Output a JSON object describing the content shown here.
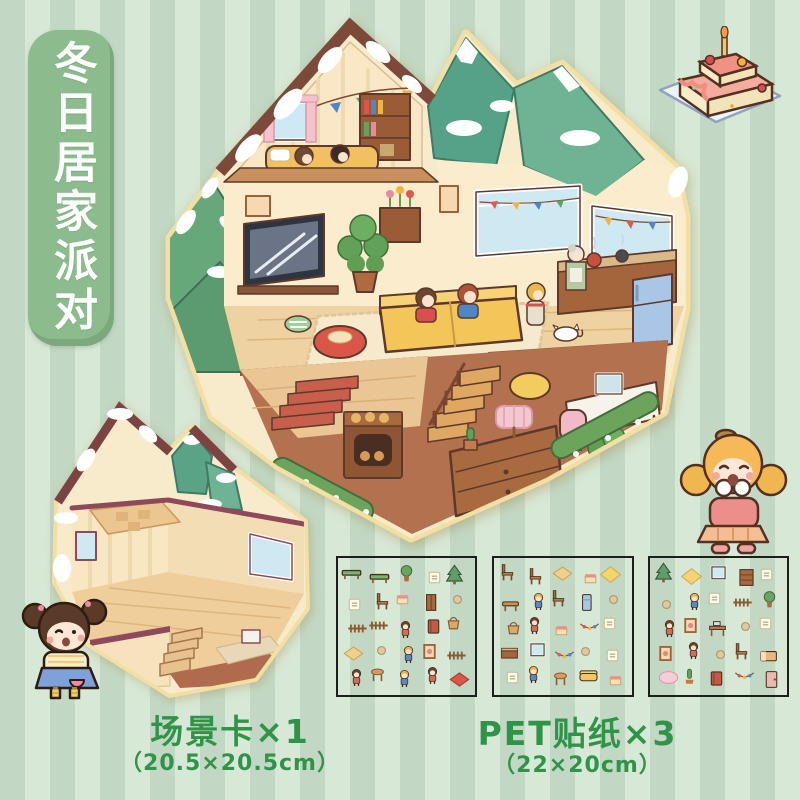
{
  "page": {
    "width": 800,
    "height": 800,
    "background_stripe_dark": "#c3d8c4",
    "background_stripe_light": "#d8e8d6"
  },
  "banner": {
    "title": "冬日居家派对",
    "bg_color": "#8cbb8e",
    "text_color": "#ffffff"
  },
  "main_scene": {
    "name": "winter-cabin-cutaway-dollhouse",
    "description": "Isometric cutaway winter cabin: snowy roof and pines, attic bedroom with bunting, living room with TV and yellow sofa, kitchen, dining table with cake, study desk, stairs and many characters"
  },
  "scene_card_preview": {
    "name": "empty-room-scene-card",
    "description": "Unfurnished isometric room with wooden floors, stairs, windows and snow-capped pines"
  },
  "cake_sticker": {
    "name": "birthday-cake",
    "description": "Two-tier pink frosted cake with candle on a plate"
  },
  "characters": {
    "right": "blonde pigtail girl in pink sweater giggling",
    "bottom_left": "brown-bun girl in blue overall dress winking"
  },
  "sticker_sheets": [
    {
      "items": [
        "bench",
        "bench",
        "plant",
        "note",
        "tree",
        "note",
        "chair",
        "snack",
        "wardrobe",
        "misc",
        "fence",
        "fence",
        "kid",
        "book",
        "basket",
        "rug",
        "misc",
        "kidb",
        "frame",
        "fence",
        "kid",
        "stool",
        "kidb",
        "kid",
        "rugred"
      ]
    },
    {
      "items": [
        "chair",
        "chair",
        "rug",
        "snack",
        "rugyellow",
        "table",
        "kidb",
        "chair",
        "fridge",
        "misc",
        "basket",
        "kid",
        "snack",
        "garland",
        "note",
        "counter",
        "window",
        "garland",
        "misc",
        "note",
        "note",
        "kidb",
        "stool",
        "sofa",
        "snack"
      ]
    },
    {
      "items": [
        "tree",
        "rugyellow",
        "window",
        "shelf",
        "note",
        "misc",
        "kidb",
        "note",
        "fence",
        "plant",
        "kid",
        "frame",
        "desk",
        "misc",
        "note",
        "frame",
        "kid",
        "misc",
        "chair",
        "bed",
        "rugpink",
        "cactus",
        "book",
        "garland",
        "door"
      ]
    }
  ],
  "captions": {
    "scene_card": {
      "line1": "场景卡×1",
      "line2": "（20.5×20.5cm）"
    },
    "pet_sticker": {
      "line1": "PET贴纸×3",
      "line2": "（22×20cm）"
    },
    "text_color": "#2f9447"
  }
}
